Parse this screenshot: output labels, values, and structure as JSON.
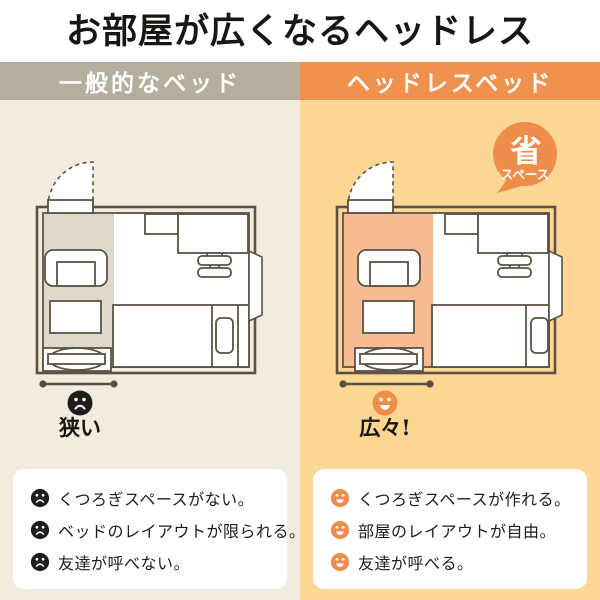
{
  "title": "お部屋が広くなるヘッドレス",
  "left": {
    "header": "一般的なベッド",
    "mood": "狭い",
    "cons": [
      "くつろぎスペースがない。",
      "ベッドのレイアウトが限られる。",
      "友達が呼べない。"
    ]
  },
  "right": {
    "header": "ヘッドレスベッド",
    "badge_main": "省",
    "badge_sub": "スペース",
    "mood": "広々!",
    "pros": [
      "くつろぎスペースが作れる。",
      "部屋のレイアウトが自由。",
      "友達が呼べる。"
    ]
  },
  "colors": {
    "header_gray": "#b5ae9e",
    "header_orange": "#f0914d",
    "panel_cream": "#f2ecdf",
    "panel_light_orange": "#fcd794",
    "free_space_gray": "#ded9ca",
    "free_space_orange": "#f7bc92",
    "outline_brown": "#5b5244",
    "badge_orange": "#ee8e4a",
    "sad_face_black": "#1e1d1b",
    "text_dark": "#1f1d1a"
  }
}
